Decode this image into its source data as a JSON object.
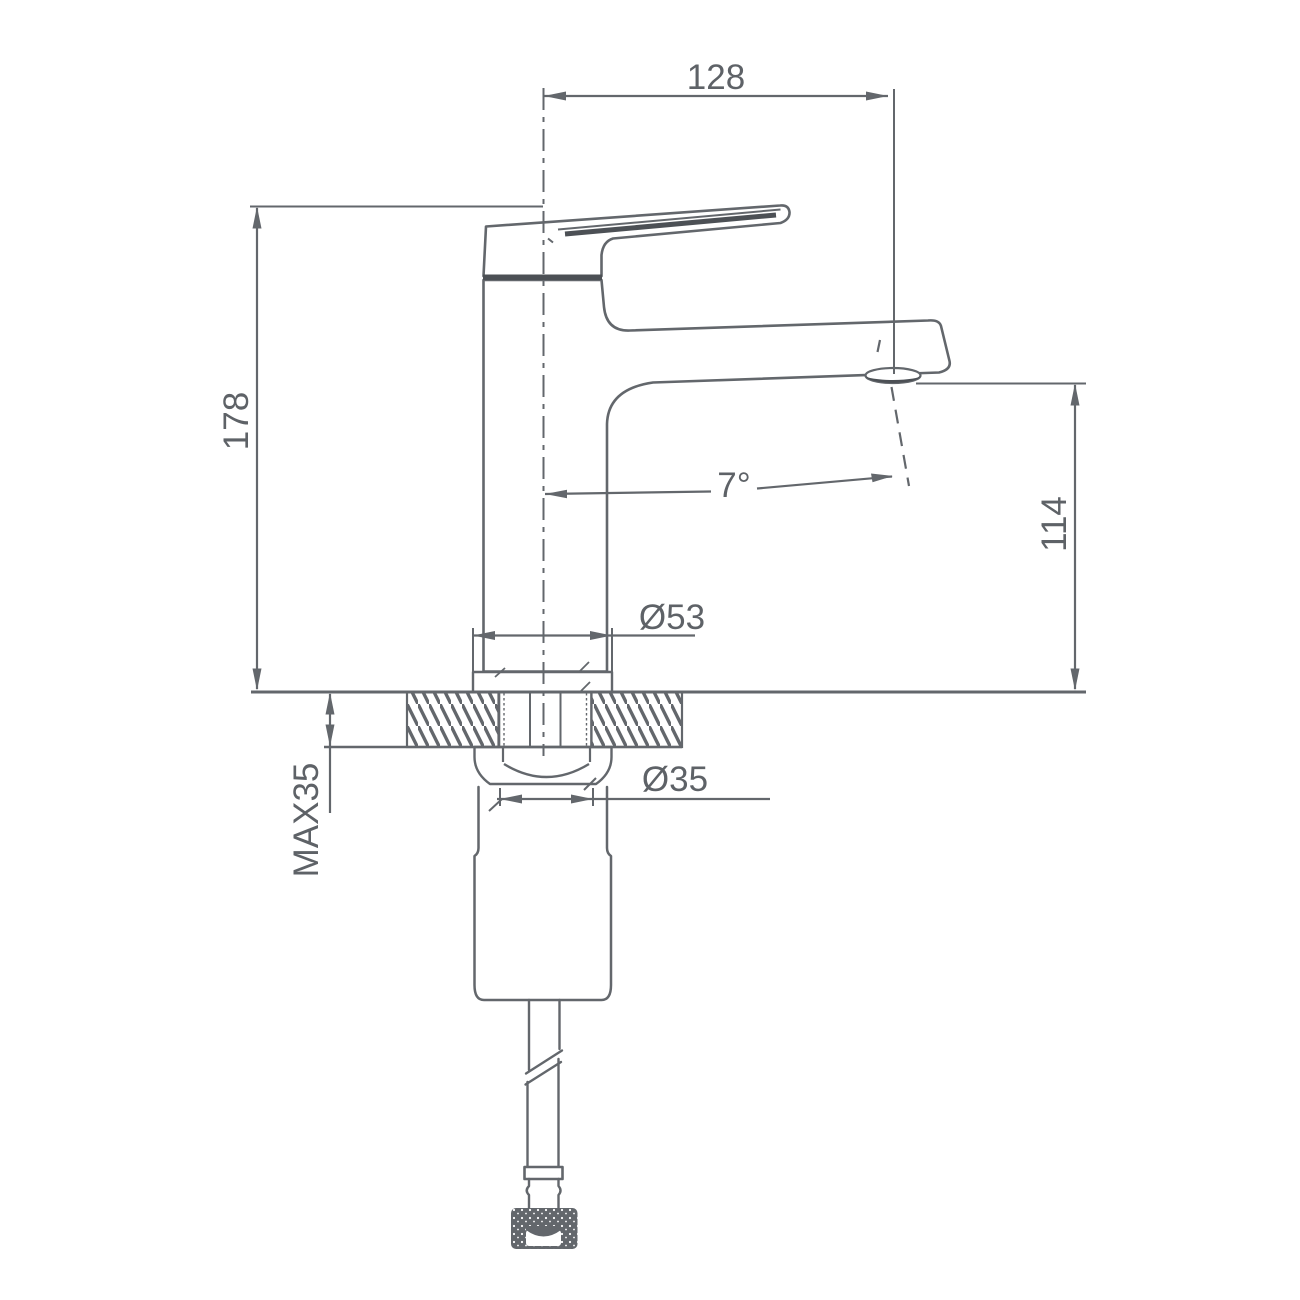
{
  "drawing": {
    "kind": "faucet-installation-dimension-drawing",
    "dimensions": {
      "spout_width": "128",
      "total_height": "178",
      "spout_angle": "7°",
      "spout_height": "114",
      "base_diameter": "Ø53",
      "mount_hole_diameter": "Ø35",
      "max_deck_thickness": "MAX35"
    },
    "colors": {
      "line": "#63676c",
      "dark_accent": "#4c5055",
      "background": "#ffffff"
    }
  }
}
